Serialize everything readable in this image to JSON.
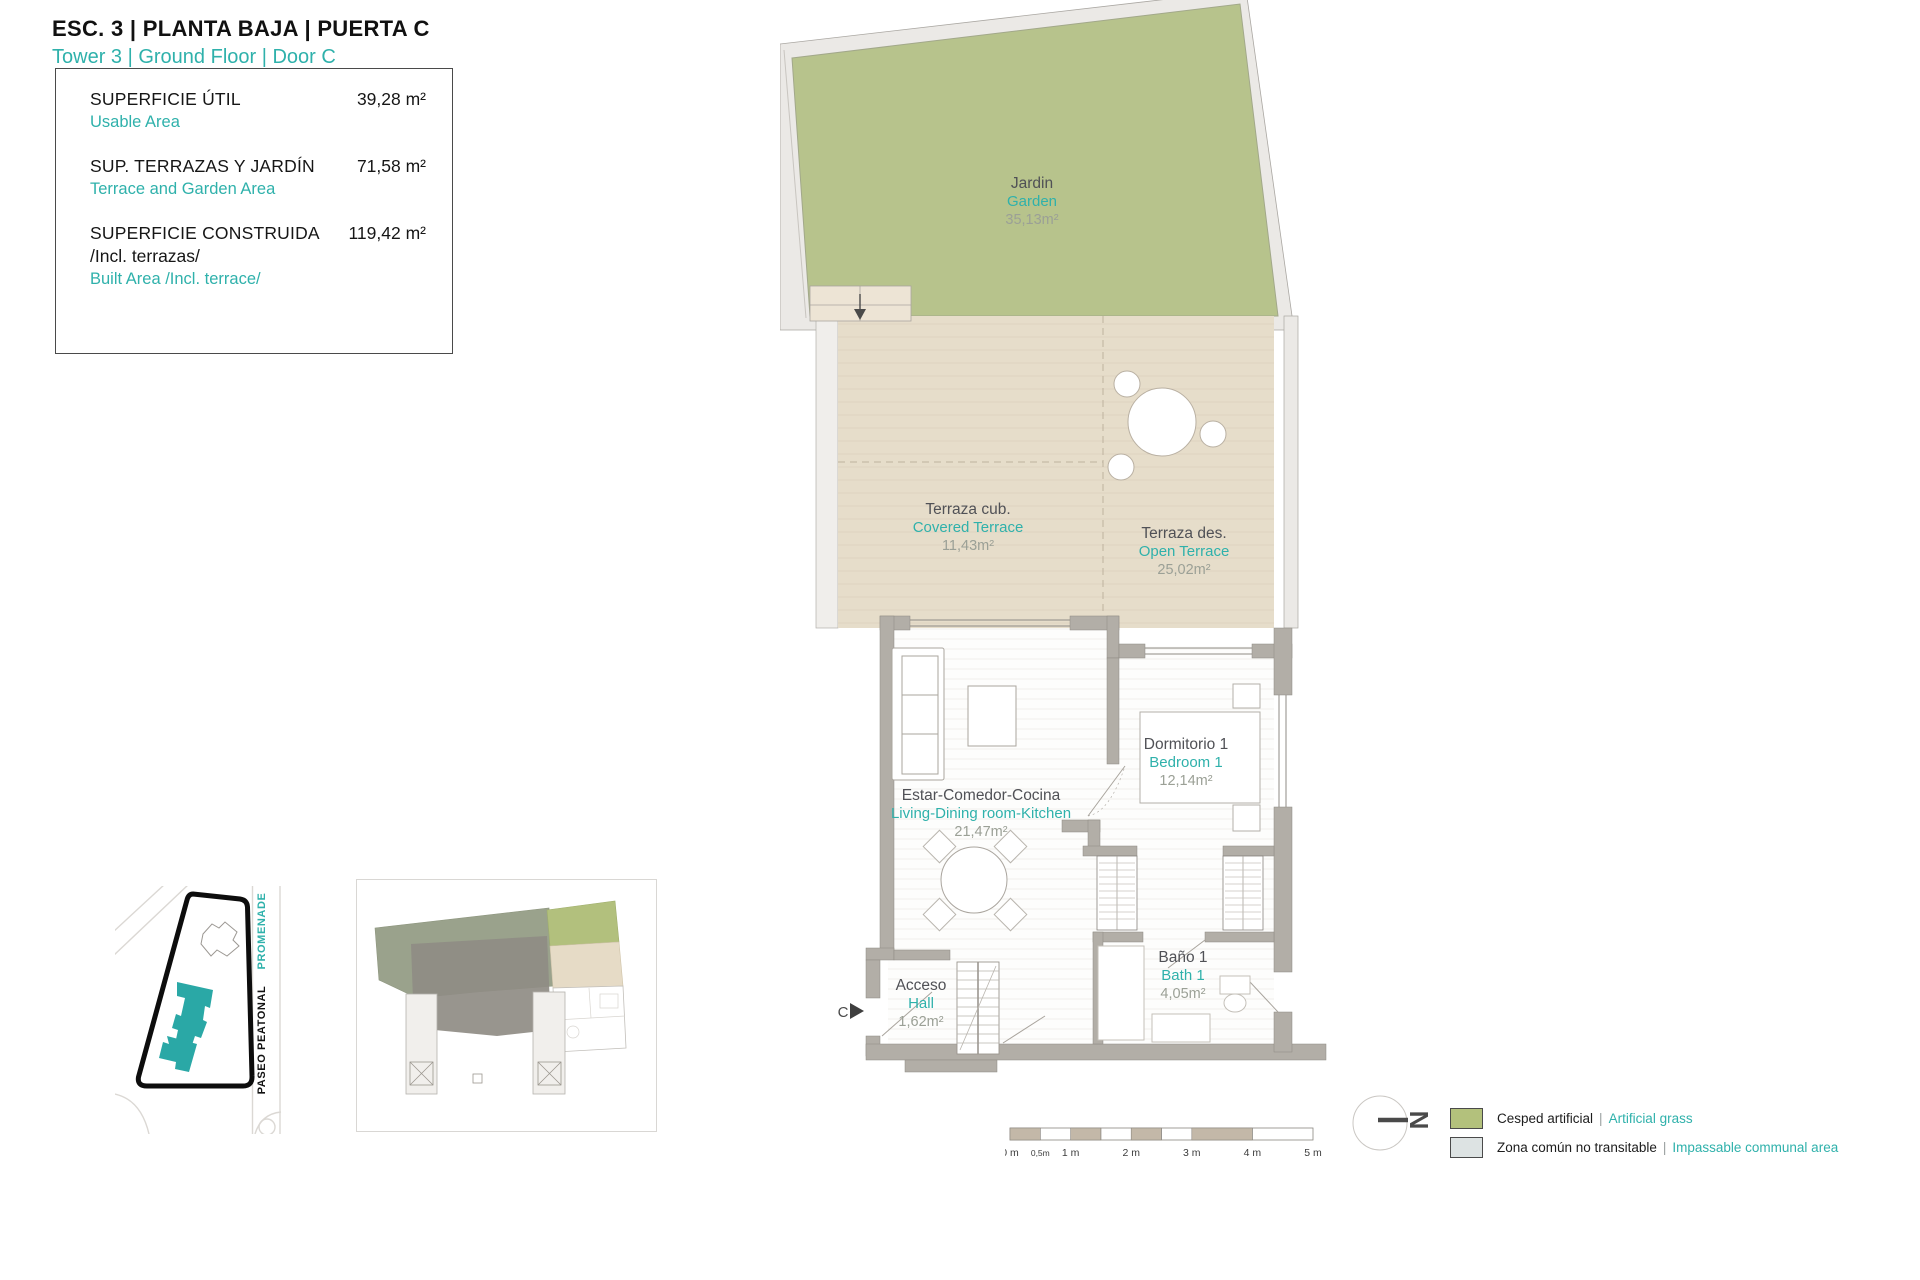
{
  "header": {
    "title": "ESC. 3 | PLANTA BAJA | PUERTA C",
    "subtitle": "Tower 3 | Ground Floor | Door C"
  },
  "info_box": {
    "rows": [
      {
        "es": "SUPERFICIE ÚTIL",
        "en": "Usable Area",
        "value": "39,28 m²"
      },
      {
        "es": "SUP. TERRAZAS Y JARDÍN",
        "en": "Terrace and Garden Area",
        "value": "71,58 m²"
      },
      {
        "es": "SUPERFICIE CONSTRUIDA",
        "es2": "/Incl. terrazas/",
        "en": "Built Area /Incl. terrace/",
        "value": "119,42 m²"
      }
    ]
  },
  "plan": {
    "garden": {
      "es": "Jardin",
      "en": "Garden",
      "area": "35,13m²"
    },
    "covered_terrace": {
      "es": "Terraza cub.",
      "en": "Covered Terrace",
      "area": "11,43m²"
    },
    "open_terrace": {
      "es": "Terraza des.",
      "en": "Open Terrace",
      "area": "25,02m²"
    },
    "living": {
      "es": "Estar-Comedor-Cocina",
      "en": "Living-Dining room-Kitchen",
      "area": "21,47m²"
    },
    "bedroom": {
      "es": "Dormitorio 1",
      "en": "Bedroom 1",
      "area": "12,14m²"
    },
    "bath": {
      "es": "Baño 1",
      "en": "Bath 1",
      "area": "4,05m²"
    },
    "hall": {
      "es": "Acceso",
      "en": "Hall",
      "area": "1,62m²"
    },
    "entrance_marker": "C"
  },
  "site_map": {
    "street_es": "PASEO PEATONAL",
    "street_en": "PROMENADE"
  },
  "scale_bar": {
    "labels": [
      "0 m",
      "0,5m",
      "1 m",
      "2 m",
      "3 m",
      "4 m",
      "5 m"
    ]
  },
  "north": {
    "letter": "N"
  },
  "legend": {
    "items": [
      {
        "es": "Cesped artificial",
        "sep": "|",
        "en": "Artificial grass",
        "color": "#b3c17c"
      },
      {
        "es": "Zona común no transitable",
        "sep": "|",
        "en": "Impassable communal area",
        "color": "#dde3e3"
      }
    ]
  },
  "colors": {
    "accent_teal": "#2fb1ab",
    "garden_green": "#b7c38c",
    "terrace_beige": "#e6ddca",
    "communal_grey": "#ebe9e6",
    "wall_grey": "#b2aea7",
    "highlight_building_teal": "#2aa8a6",
    "scale_segment": "#c3b8a8"
  }
}
